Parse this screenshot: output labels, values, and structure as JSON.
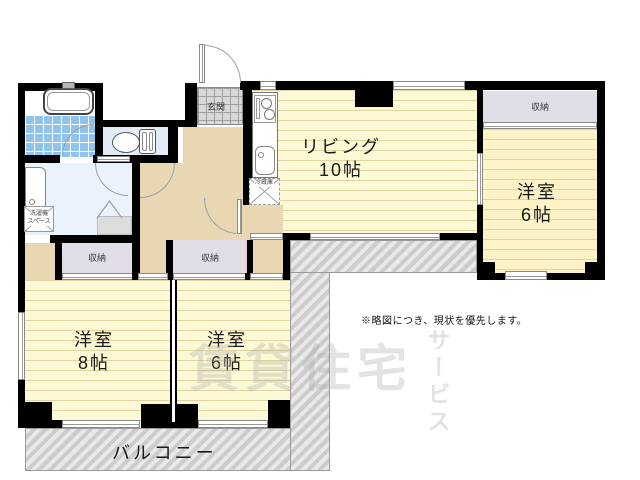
{
  "floorplan": {
    "rooms": {
      "living": {
        "name": "リビング",
        "size": "10帖"
      },
      "western_right": {
        "name": "洋室",
        "size": "6帖"
      },
      "western_left": {
        "name": "洋室",
        "size": "8帖"
      },
      "western_center": {
        "name": "洋室",
        "size": "6帖"
      }
    },
    "closet_labels": [
      "収納",
      "収納",
      "収納"
    ],
    "entrance_label": "玄関",
    "balcony_label": "バルコニー",
    "refrigerator_label": "冷蔵庫",
    "laundry_label_line1": "洗濯機",
    "laundry_label_line2": "スペース",
    "note": "※略図につき、現状を優先します。",
    "watermark": {
      "main": "賃貸住宅",
      "vertical": "サービス"
    },
    "colors": {
      "wall": "#000000",
      "room_floor": "#fdf8d5",
      "room_stripe": "#cbb670",
      "hall_floor": "#e9d6b2",
      "closet_floor": "#e2dee8",
      "bath_tile": "#8fc4ee",
      "toilet_floor": "#e2ebf6",
      "washroom_floor": "#eaf2fb",
      "entrance_tile": "#d8d8d8",
      "outside_hatch": "#d2d2d2"
    }
  }
}
